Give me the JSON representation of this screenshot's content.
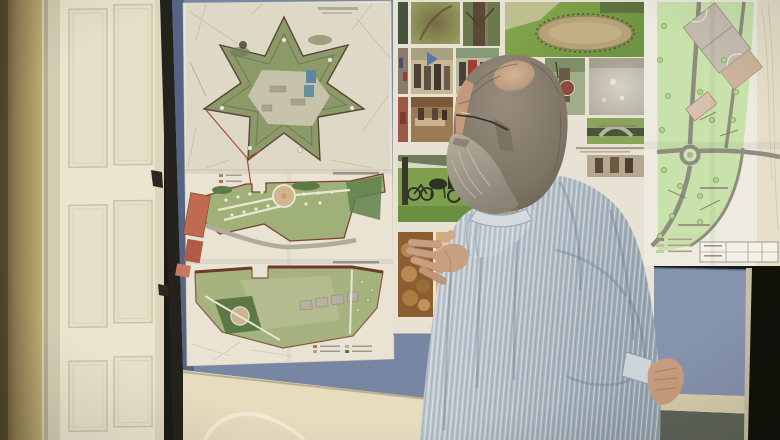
{
  "scene": {
    "type": "photograph",
    "description": "A gray-haired man with a beard and glasses, wearing a light striped shirt, stands before blue display boards gesturing at urban-planning posters: a star-shaped fortress site plan above two green landscape plans, a collage of park and reenactment photos, and a large light-green park plan drawing; a cream paneled door and ochre wall are on the left.",
    "setting": "indoor exhibition room",
    "regions": {
      "left_wall": {
        "label": "ochre wall"
      },
      "door": {
        "label": "cream six-panel door"
      },
      "easel_pole": {
        "label": "black board stand pole with hooks"
      },
      "left_board": {
        "label": "blue display board"
      },
      "fortress_poster": {
        "label": "star fortress site plan on beige city map"
      },
      "landscape_plan_1": {
        "label": "green landscape plan with circular plaza and red buildings"
      },
      "landscape_plan_2": {
        "label": "green landscape plan with gray buildings and tree circle"
      },
      "photo_collage": {
        "label": "photo collage panel",
        "photos": [
          "trees",
          "tree canopy",
          "tree trunk",
          "oval riding paddock in lawn",
          "costumed reenactors with flag",
          "reenactors with red garment",
          "reenactor with round shield",
          "hazy smoke scene",
          "market stall",
          "performers",
          "stone bridge over moat",
          "park with horse carriage and bicycles",
          "dark bread loaves",
          "light pastries",
          "market table with red cloth"
        ]
      },
      "park_plan_poster": {
        "label": "light-green park plan with roads, roundabout, sports courts and title block"
      },
      "lower_blue_panel": {
        "label": "lower blue display panel"
      },
      "dark_right_edge": {
        "label": "dark doorway strip at right edge"
      },
      "man": {
        "label": "man seen from behind-right, balding gray-brown hair, glasses, gray beard, striped light blue shirt, left hand gesturing open"
      }
    }
  },
  "palette": {
    "wall_dark": "#6d5f3e",
    "wall": "#c7b378",
    "door_cream": "#ebe4ce",
    "pole_black": "#24221d",
    "board_blue": "#7686a3",
    "board_blue_light": "#8693ad",
    "poster_paper": "#e9e3d4",
    "map_beige": "#ded8c6",
    "fort_green": "#8c9a6a",
    "plan_green": "#9fb078",
    "plan_outline_red": "#7c4434",
    "plaza_tan": "#d2b58c",
    "building_red": "#c06a50",
    "park_plan_green": "#c9e2ab",
    "road_gray": "#8f8d80",
    "photo_grass": "#6f9340",
    "bread_brown": "#8a5e30",
    "skin": "#c49a7b",
    "hair": "#857b6d",
    "beard": "#a49c8e",
    "shirt": "#b7c1c9",
    "floor_gray": "#5f6459",
    "dark_strip": "#11130b"
  }
}
